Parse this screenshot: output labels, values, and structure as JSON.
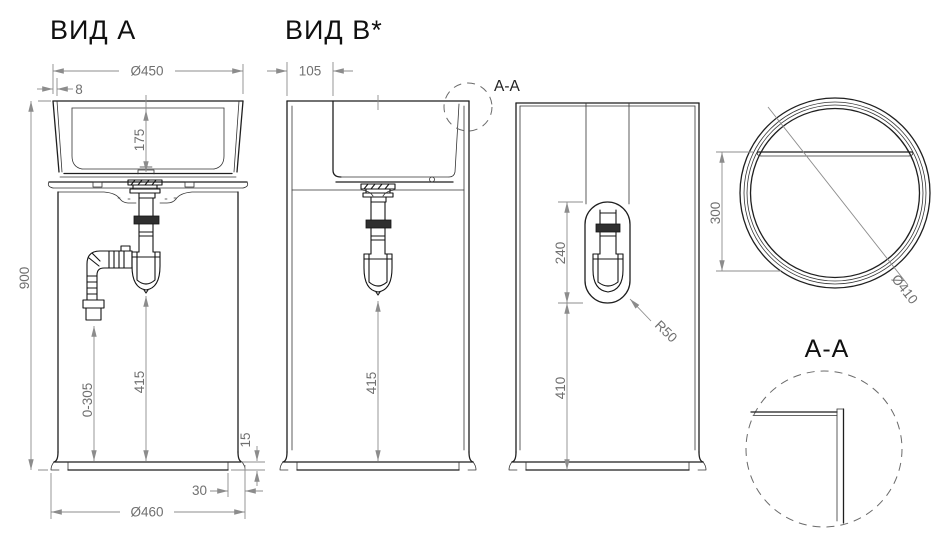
{
  "document": {
    "type": "sanitary-ware technical drawing, freestanding pedestal washbasin"
  },
  "colors": {
    "outline": "#1f1f1f",
    "dimension_lines": "#8c8c8c",
    "dimension_text": "#707070",
    "title_text": "#101010",
    "background": "#ffffff"
  },
  "view_a": {
    "title": "ВИД А",
    "dim_top_width": "Ø450",
    "dim_wall": "8",
    "dim_basin_depth": "175",
    "dim_height": "900",
    "dim_hose_drop": "0-305",
    "dim_trap_drop": "415",
    "dim_plinth_height": "15",
    "dim_plinth_inset": "30",
    "dim_bottom_width": "Ø460"
  },
  "view_b": {
    "title": "ВИД B*",
    "dim_back_ledge": "105",
    "dim_trap_drop": "415",
    "section_marker": "A-A"
  },
  "view_back": {
    "dim_cutout_height": "240",
    "dim_cutout_to_base": "410",
    "dim_cutout_radius": "R50"
  },
  "view_top": {
    "dim_ledge_depth": "300",
    "dim_diameter": "Ø410"
  },
  "section_aa": {
    "title": "A-A"
  }
}
